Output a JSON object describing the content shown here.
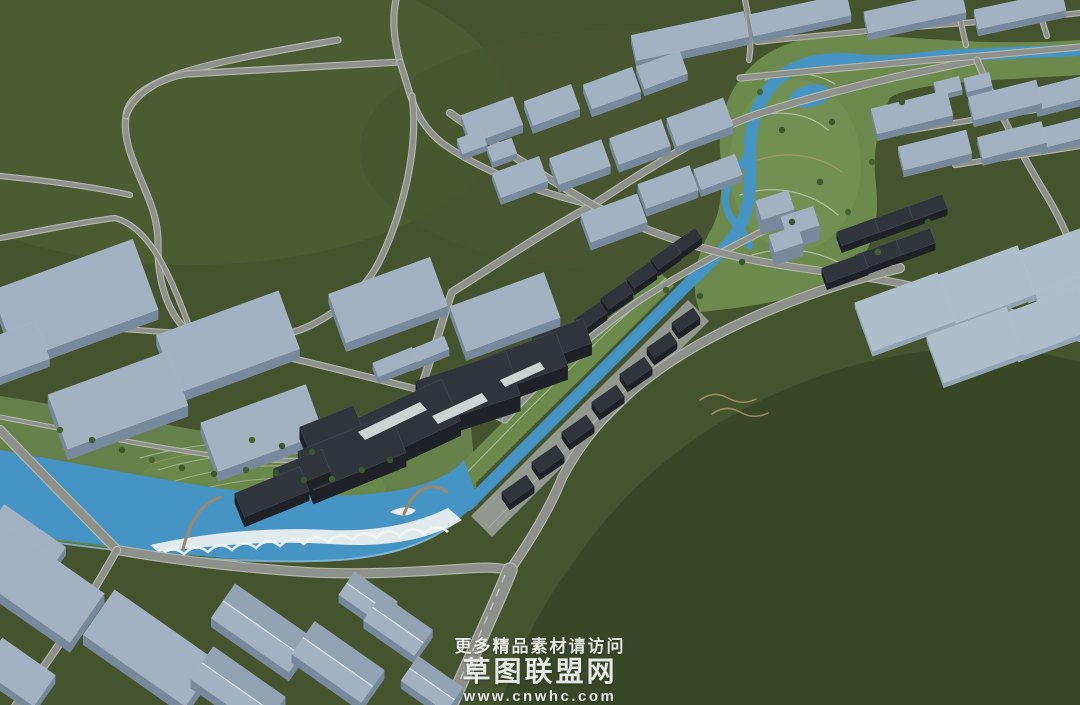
{
  "watermark": {
    "line1": "更多精品素材请访问",
    "line2": "草图联盟网",
    "line3": "www.cnwhc.com"
  },
  "palette": {
    "terrain": "#46532f",
    "terrain_light": "#4d5b33",
    "hill_dark": "#3a4727",
    "road": "#8e918b",
    "road_casing": "#b4b7ac",
    "lane_dash": "#c6c9bd",
    "water": "#4694c4",
    "water_light": "#8fc0dc",
    "park": "#66814b",
    "park_strip": "#6d8a4e",
    "promenade": "#9aa09a",
    "beach_white": "#eaeeee",
    "building_light_top": "#a3b2c2",
    "building_light_side": "#76899d",
    "building_pad_top": "#afbecb",
    "building_pad_side": "#91a5b5",
    "building_dark_top": "#30353c",
    "building_dark_side": "#1e2227",
    "gable_ridge": "#dde3e8",
    "trim_white": "#dfe3e3",
    "bridge": "#9b8767",
    "tree": "#3b572d"
  },
  "scene": {
    "base": {
      "w": 1080,
      "h": 705,
      "fill": "#46532f"
    },
    "patches": [
      {
        "cx": 190,
        "cy": 110,
        "rx": 320,
        "ry": 155,
        "fill": "#4d5b33",
        "op": 1
      },
      {
        "cx": 620,
        "cy": 150,
        "rx": 260,
        "ry": 120,
        "fill": "#495631",
        "op": 0.8
      },
      {
        "cx": 795,
        "cy": 165,
        "rx": 68,
        "ry": 88,
        "fill": "#769558",
        "op": 0
      },
      {
        "cx": 260,
        "cy": 490,
        "rx": 130,
        "ry": 52,
        "fill": "#70904f",
        "op": 0
      }
    ],
    "hill": {
      "d": "M500,706 C520,645 545,600 578,556 C622,492 682,442 742,410 C822,368 902,348 982,348 C1016,348 1050,354 1080,362 L1080,706 Z",
      "fill": "#3a4727"
    },
    "parks": [
      {
        "d": "M0,396 C90,410 180,428 268,442 C335,452 395,448 442,432 L470,416 L478,505 C420,545 350,560 280,560 C180,558 90,545 0,535 Z",
        "fill": "#66814b"
      },
      {
        "d": "M440,485 L517,408 L597,329 L657,269 L674,286 L614,346 L534,425 L457,502 Z",
        "fill": "#6d8a4e"
      },
      {
        "d": "M700,312 C688,282 698,252 712,228 C724,204 722,176 720,150 C718,116 730,84 756,62 C782,40 822,32 866,35 L945,40 C990,43 1035,43 1080,40 L1080,75 C1030,78 985,80 945,84 C915,88 898,92 890,98 C878,124 872,152 876,186 C880,222 872,252 852,270 C822,296 760,306 700,312 Z",
        "fill": "#6d8a4e"
      }
    ],
    "park_patches": [
      {
        "cx": 795,
        "cy": 165,
        "rx": 66,
        "ry": 86,
        "fill": "#769558",
        "op": 0.55
      },
      {
        "cx": 260,
        "cy": 490,
        "rx": 125,
        "ry": 50,
        "fill": "#70904f",
        "op": 0.5
      }
    ],
    "promenade": {
      "d": "M471,516 L548,439 L628,360 L688,300 L709,321 L649,381 L569,460 L492,537 Z",
      "fill": "#9aa09a",
      "op": 0.9
    },
    "park_lines": [
      {
        "d": "M140,458 C210,438 300,436 372,450",
        "s": "#c8cbb8",
        "w": 1,
        "o": 0.65
      },
      {
        "d": "M158,470 C222,450 302,448 362,462",
        "s": "#c8cbb8",
        "w": 1,
        "o": 0.6
      },
      {
        "d": "M172,482 C232,463 300,461 352,474",
        "s": "#c8cbb8",
        "w": 1,
        "o": 0.6
      },
      {
        "d": "M186,494 C242,476 300,474 344,486",
        "s": "#c8cbb8",
        "w": 1,
        "o": 0.55
      },
      {
        "d": "M150,464 C215,444 300,442 366,456",
        "s": "#b29a6c",
        "w": 1,
        "o": 0.6
      },
      {
        "d": "M745,120 C775,108 808,112 828,130",
        "s": "#cbd0ba",
        "w": 1.2,
        "o": 0.7
      },
      {
        "d": "M740,195 C775,183 812,192 838,215",
        "s": "#cbd0ba",
        "w": 1.2,
        "o": 0.7
      },
      {
        "d": "M752,255 C785,245 818,250 845,266",
        "s": "#cbd0ba",
        "w": 1.2,
        "o": 0.7
      },
      {
        "d": "M765,80 C790,70 815,72 835,84",
        "s": "#cbd0ba",
        "w": 1.2,
        "o": 0.7
      },
      {
        "d": "M758,160 C788,150 818,155 842,172",
        "s": "#b29a6c",
        "w": 1.2,
        "o": 0.7
      },
      {
        "d": "M448,492 L524,414 L604,335 L666,278",
        "s": "#cfd3c3",
        "w": 1,
        "o": 0.6
      },
      {
        "d": "M488,528 L565,450 L645,372 L700,318",
        "s": "#c6cac2",
        "w": 1,
        "o": 0.5
      },
      {
        "d": "M700,400 q14,-10 28,-2 q14,8 28,1",
        "s": "#b49b6f",
        "w": 1.5,
        "o": 0.8
      },
      {
        "d": "M712,414 q14,-10 28,-2 q14,8 28,1",
        "s": "#b49b6f",
        "w": 1.5,
        "o": 0.8
      }
    ],
    "river": {
      "body_d": "M0,450 C70,462 140,476 210,487 C280,497 350,499 400,490 C430,484 452,474 464,460 L478,500 C460,522 432,540 396,552 C340,566 270,562 200,556 C130,549 60,540 0,532 Z",
      "canal_d": "M468,505 L680,292 C706,265 730,248 742,222 C752,200 750,175 750,152 C750,125 757,100 775,82 C795,62 825,56 858,60 C885,63 912,60 942,56 L1080,50",
      "canal_w": 12,
      "side_loop_d": "M750,150 C738,172 722,186 726,206 C730,224 746,230 750,246",
      "side_loop_w": 7,
      "shore_d": "M8,536 C120,552 240,566 340,560 C390,556 430,544 458,520",
      "beach_d": "M150,545 C210,532 270,527 330,530 C375,532 415,524 448,508 L462,520 C430,540 385,548 330,544 C270,540 210,546 158,552 Z",
      "island_d": "M390,512 q14,-8 26,-2 q-8,10 -26,2 Z",
      "scallops_d": "M160,556 Q172,544 184,554 Q196,542 208,552 Q220,540 232,550 Q244,538 256,548 Q268,536 280,546 Q292,534 304,544 Q316,532 328,542 Q340,530 352,540 Q364,528 376,538 Q388,526 400,536 Q412,524 424,534 Q436,522 448,532",
      "ponds": [
        {
          "cx": 810,
          "cy": 96,
          "rx": 21,
          "ry": 11,
          "rot": -12
        },
        {
          "cx": 852,
          "cy": 238,
          "rx": 16,
          "ry": 9,
          "rot": -20
        }
      ]
    },
    "roads": [
      {
        "n": "loop-outer",
        "d": "M338,40 C225,60 130,75 126,116 C120,158 159,197 158,243 C157,292 174,322 192,334",
        "w": 5
      },
      {
        "n": "loop-chord",
        "d": "M126,116 C133,94 160,78 187,74 C255,70 330,66 400,62",
        "w": 5
      },
      {
        "n": "top-entry",
        "d": "M396,0 C392,18 394,40 400,62",
        "w": 5
      },
      {
        "n": "j2-south",
        "d": "M400,62 C412,98 414,120 442,143 C480,170 535,192 593,205",
        "w": 5
      },
      {
        "n": "diag-west",
        "d": "M412,96 C420,155 398,225 378,264 C362,294 330,318 300,330 C260,344 220,343 192,334",
        "w": 5
      },
      {
        "n": "west-stub-1",
        "d": "M0,176 C50,181 95,187 130,195",
        "w": 4
      },
      {
        "n": "west-stub-2",
        "d": "M0,238 C45,230 82,222 115,218 C152,228 172,280 192,334",
        "w": 4
      },
      {
        "n": "jb-west",
        "d": "M192,334 C130,330 60,324 0,320",
        "w": 4
      },
      {
        "n": "jb-east",
        "d": "M192,334 C270,353 350,372 420,390 C450,397 480,408 505,420",
        "w": 5
      },
      {
        "n": "nw-canal-road",
        "d": "M505,420 C545,375 590,335 640,300 C690,268 735,245 775,225",
        "w": 5
      },
      {
        "n": "x-diag-sw",
        "d": "M420,390 C435,350 442,320 452,292 C500,262 550,228 593,205 C660,160 712,130 755,115 C800,100 860,85 900,76 C940,68 965,62 977,60",
        "w": 6
      },
      {
        "n": "x-diag-se",
        "d": "M450,113 C505,152 550,180 593,205 C660,240 730,258 800,268 C850,275 890,280 920,288 C970,298 1025,316 1080,338",
        "w": 6
      },
      {
        "n": "strip-south-road",
        "d": "M740,78 C820,70 900,62 980,56 C1015,53 1050,50 1080,47",
        "w": 5
      },
      {
        "n": "strip-north-road",
        "d": "M757,42 C830,34 910,27 990,21 C1030,18 1055,16 1080,13",
        "w": 4
      },
      {
        "n": "park-east-road",
        "d": "M977,60 C995,105 1020,152 1048,198 C1060,218 1072,244 1078,268",
        "w": 5
      },
      {
        "n": "x-top",
        "d": "M745,0 C750,22 752,42 749,60",
        "w": 4
      },
      {
        "n": "top-v1",
        "d": "M955,0 C960,18 963,32 966,45",
        "w": 4
      },
      {
        "n": "top-v2",
        "d": "M1035,0 C1040,14 1044,26 1047,36",
        "w": 4
      },
      {
        "n": "right-street-1",
        "d": "M900,132 C960,122 1020,112 1080,103",
        "w": 4
      },
      {
        "n": "right-street-2",
        "d": "M955,165 C1000,158 1045,152 1080,146",
        "w": 4
      },
      {
        "n": "se-bank-road",
        "d": "M510,570 C532,538 550,508 562,478 C592,420 640,378 698,345 C760,310 830,285 900,268",
        "w": 8
      },
      {
        "n": "south-bank-road",
        "d": "M0,430 C45,477 85,517 117,550 C180,561 245,568 305,572 C370,576 438,570 475,568 C488,567 500,568 510,570",
        "w": 8
      },
      {
        "n": "bottom-left-road",
        "d": "M117,550 C97,585 62,645 15,706",
        "w": 6
      },
      {
        "n": "north-bank-road",
        "d": "M0,417 C70,430 140,445 210,455 C262,462 315,462 360,456 C385,452 405,446 420,438",
        "w": 3
      }
    ],
    "avenue": {
      "n": "south-avenue",
      "d": "M510,570 C494,610 470,660 450,706",
      "w": 13,
      "dash_d": "M505,575 C490,612 468,660 451,702"
    },
    "bridges": [
      {
        "d": "M183,549 C190,520 202,504 220,497",
        "w": 3
      },
      {
        "d": "M404,514 C414,489 430,480 447,492",
        "w": 3
      }
    ],
    "complex_trim": [
      {
        "d": "M358,432 L420,402 L427,410 L365,440 Z"
      },
      {
        "d": "M432,416 L482,393 L488,401 L438,424 Z"
      },
      {
        "d": "M500,380 L540,362 L545,369 L505,387 Z"
      }
    ],
    "buildings": [
      [
        75,
        300,
        150,
        75,
        -20,
        10,
        0
      ],
      [
        228,
        342,
        130,
        62,
        -20,
        10,
        0
      ],
      [
        118,
        400,
        128,
        58,
        -20,
        11,
        0
      ],
      [
        262,
        428,
        112,
        52,
        -20,
        10,
        0
      ],
      [
        388,
        300,
        108,
        52,
        -20,
        9,
        0
      ],
      [
        505,
        312,
        100,
        48,
        -20,
        9,
        0
      ],
      [
        10,
        352,
        70,
        40,
        -20,
        8,
        0
      ],
      [
        395,
        362,
        42,
        15,
        -22,
        7,
        0
      ],
      [
        428,
        350,
        40,
        14,
        -22,
        7,
        0
      ],
      [
        492,
        120,
        55,
        30,
        -20,
        8,
        0
      ],
      [
        552,
        105,
        50,
        26,
        -20,
        8,
        0
      ],
      [
        612,
        88,
        52,
        26,
        -20,
        8,
        0
      ],
      [
        662,
        70,
        46,
        24,
        -20,
        7,
        0
      ],
      [
        700,
        122,
        60,
        30,
        -20,
        8,
        0
      ],
      [
        640,
        142,
        55,
        28,
        -20,
        8,
        0
      ],
      [
        580,
        162,
        55,
        28,
        -20,
        8,
        0
      ],
      [
        520,
        177,
        50,
        26,
        -20,
        7,
        0
      ],
      [
        614,
        218,
        60,
        30,
        -20,
        8,
        0
      ],
      [
        668,
        187,
        55,
        26,
        -20,
        8,
        0
      ],
      [
        718,
        172,
        44,
        22,
        -20,
        7,
        0
      ],
      [
        472,
        142,
        26,
        16,
        -20,
        6,
        0
      ],
      [
        502,
        150,
        26,
        16,
        -20,
        6,
        0
      ],
      [
        690,
        36,
        115,
        26,
        -12,
        8,
        0
      ],
      [
        800,
        15,
        100,
        22,
        -12,
        7,
        0
      ],
      [
        915,
        12,
        100,
        22,
        -12,
        7,
        0
      ],
      [
        1020,
        10,
        90,
        20,
        -12,
        7,
        0
      ],
      [
        912,
        112,
        78,
        26,
        -14,
        7,
        0
      ],
      [
        1005,
        100,
        70,
        24,
        -14,
        7,
        0
      ],
      [
        1064,
        92,
        60,
        22,
        -14,
        7,
        0
      ],
      [
        935,
        150,
        70,
        24,
        -14,
        7,
        0
      ],
      [
        1012,
        140,
        66,
        22,
        -14,
        7,
        0
      ],
      [
        1066,
        132,
        56,
        20,
        -14,
        6,
        0
      ],
      [
        948,
        86,
        26,
        14,
        -14,
        5,
        0
      ],
      [
        978,
        82,
        26,
        14,
        -14,
        5,
        0
      ],
      [
        775,
        205,
        34,
        20,
        -18,
        15,
        0
      ],
      [
        800,
        221,
        34,
        20,
        -18,
        15,
        0
      ],
      [
        786,
        239,
        30,
        18,
        -18,
        13,
        0
      ],
      [
        905,
        312,
        88,
        52,
        -20,
        5,
        2
      ],
      [
        985,
        285,
        88,
        52,
        -20,
        5,
        2
      ],
      [
        1058,
        262,
        80,
        48,
        -20,
        5,
        2
      ],
      [
        975,
        345,
        85,
        50,
        -20,
        5,
        2
      ],
      [
        1048,
        322,
        80,
        46,
        -20,
        5,
        2
      ],
      [
        1075,
        300,
        70,
        42,
        -20,
        5,
        2
      ],
      [
        40,
        585,
        115,
        60,
        35,
        10,
        0
      ],
      [
        150,
        648,
        125,
        55,
        35,
        10,
        0
      ],
      [
        25,
        540,
        75,
        35,
        35,
        8,
        0
      ],
      [
        18,
        672,
        65,
        38,
        35,
        8,
        0
      ],
      [
        262,
        628,
        95,
        42,
        35,
        9,
        3
      ],
      [
        238,
        688,
        88,
        40,
        35,
        9,
        3
      ],
      [
        338,
        662,
        85,
        40,
        35,
        9,
        3
      ],
      [
        398,
        625,
        62,
        32,
        35,
        8,
        3
      ],
      [
        368,
        598,
        52,
        28,
        35,
        8,
        3
      ],
      [
        432,
        684,
        55,
        30,
        35,
        8,
        3
      ],
      [
        352,
        452,
        100,
        42,
        -22,
        14,
        1
      ],
      [
        332,
        430,
        58,
        30,
        -22,
        12,
        1
      ],
      [
        408,
        420,
        95,
        46,
        -25,
        15,
        1
      ],
      [
        468,
        388,
        95,
        46,
        -18,
        16,
        1
      ],
      [
        525,
        362,
        78,
        36,
        -20,
        14,
        1
      ],
      [
        562,
        340,
        54,
        26,
        -20,
        12,
        1
      ],
      [
        272,
        492,
        70,
        26,
        -22,
        10,
        1
      ],
      [
        302,
        470,
        52,
        24,
        -22,
        10,
        1
      ],
      [
        591,
        316,
        30,
        14,
        -35,
        7,
        1
      ],
      [
        617,
        295,
        30,
        14,
        -35,
        7,
        1
      ],
      [
        642,
        275,
        28,
        13,
        -35,
        7,
        1
      ],
      [
        666,
        256,
        28,
        13,
        -35,
        7,
        1
      ],
      [
        688,
        240,
        26,
        12,
        -35,
        7,
        1
      ],
      [
        518,
        489,
        30,
        14,
        -35,
        7,
        1
      ],
      [
        548,
        459,
        30,
        14,
        -35,
        7,
        1
      ],
      [
        578,
        429,
        30,
        14,
        -35,
        7,
        1
      ],
      [
        608,
        399,
        30,
        14,
        -35,
        7,
        1
      ],
      [
        636,
        371,
        30,
        14,
        -35,
        7,
        1
      ],
      [
        662,
        345,
        28,
        13,
        -35,
        7,
        1
      ],
      [
        686,
        320,
        26,
        12,
        -35,
        7,
        1
      ],
      [
        845,
        268,
        44,
        16,
        -20,
        7,
        1
      ],
      [
        878,
        255,
        44,
        16,
        -20,
        7,
        1
      ],
      [
        912,
        243,
        44,
        16,
        -20,
        7,
        1
      ],
      [
        858,
        232,
        40,
        15,
        -20,
        7,
        1
      ],
      [
        892,
        220,
        40,
        15,
        -20,
        7,
        1
      ],
      [
        926,
        208,
        40,
        15,
        -20,
        7,
        1
      ],
      [
        965,
        280,
        40,
        15,
        -20,
        7,
        1
      ],
      [
        1000,
        268,
        40,
        15,
        -20,
        7,
        1
      ],
      [
        1032,
        256,
        40,
        15,
        -20,
        7,
        1
      ]
    ],
    "trees": [
      [
        60,
        430
      ],
      [
        92,
        440
      ],
      [
        122,
        450
      ],
      [
        152,
        460
      ],
      [
        182,
        468
      ],
      [
        214,
        474
      ],
      [
        246,
        470
      ],
      [
        276,
        473
      ],
      [
        304,
        480
      ],
      [
        332,
        479
      ],
      [
        362,
        470
      ],
      [
        390,
        460
      ],
      [
        252,
        440
      ],
      [
        282,
        446
      ],
      [
        312,
        452
      ],
      [
        760,
        92
      ],
      [
        782,
        130
      ],
      [
        820,
        182
      ],
      [
        848,
        212
      ],
      [
        792,
        222
      ],
      [
        832,
        122
      ],
      [
        872,
        162
      ],
      [
        902,
        102
      ],
      [
        928,
        222
      ],
      [
        878,
        252
      ],
      [
        742,
        262
      ],
      [
        700,
        296
      ],
      [
        666,
        290
      ]
    ]
  }
}
